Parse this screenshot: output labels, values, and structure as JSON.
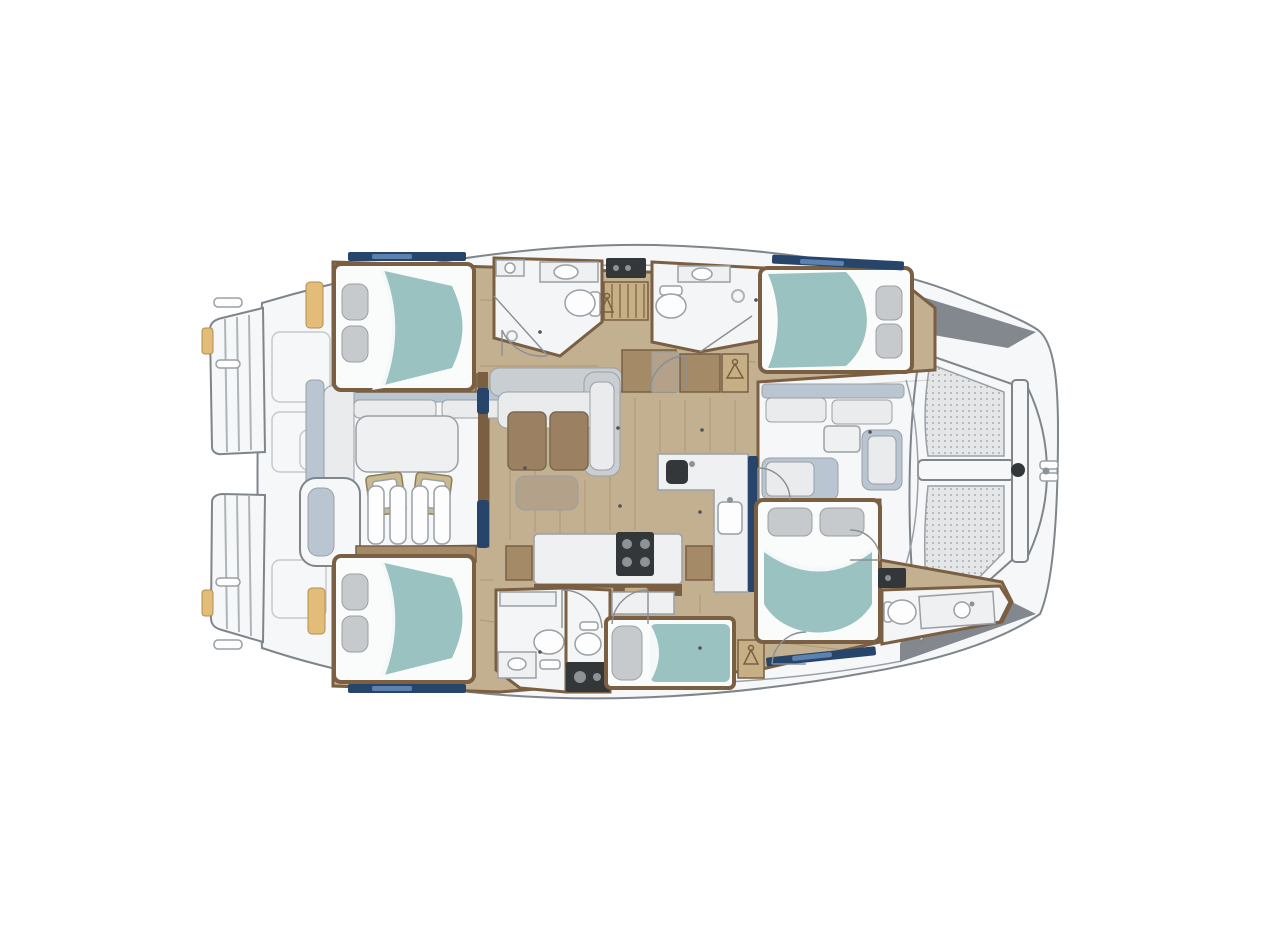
{
  "canvas": {
    "width": 1261,
    "height": 945,
    "background": "#ffffff"
  },
  "colors": {
    "background": "#ffffff",
    "outline": "#7e858b",
    "outline_soft": "#9aa0a5",
    "deck": "#f6f7f8",
    "dark_wedge": "#82888d",
    "wood_floor": "#c3b090",
    "wood_trim": "#7a5f43",
    "wood_cabinet": "#a58a68",
    "plank_line": "rgba(90,70,40,0.22)",
    "room_white": "#f4f5f6",
    "fixture_white": "#fdfdfd",
    "counter_white": "#eef0f1",
    "appliance_dark": "#33373a",
    "appliance_knob": "#8d9296",
    "bed_teal": "#9ac2c1",
    "sheet_white": "#fafbfb",
    "pillow_gray": "#c7cacc",
    "pillow_edge": "#9ba0a3",
    "sofa_gray": "#c9ced3",
    "cushion_white": "#e9ebed",
    "seat_bluegray": "#b9c6d2",
    "table_brown": "#9b8161",
    "table_edge": "#7a6a50",
    "ottoman_tan": "#b3a189",
    "locker_tan": "#c6ae85",
    "navy": "#27456b",
    "navy_light": "#5e82b0",
    "gold": "#e2bc78",
    "gold_edge": "#b18f4e",
    "chair_khaki": "#c9b98f",
    "chair_edge": "#8c7d57",
    "arc_gray": "#8a8f94",
    "step_line": "#aeb4b8",
    "panel_line": "#c6cacd",
    "floor_dot": "#4e5358",
    "mesh_bg": "#e4e6e8",
    "mesh_dot": "#a9adb1",
    "teak_dark": "#6f5540"
  },
  "boat": {
    "kind": "catamaran-yacht-floor-plan",
    "orientation": "bow-right",
    "rooms": [
      {
        "id": "aft-cockpit",
        "type": "cockpit-with-table-and-helm",
        "position": "stern-left"
      },
      {
        "id": "port-aft-cabin",
        "type": "double-bed-cabin",
        "position": "top-left"
      },
      {
        "id": "port-aft-head",
        "type": "bathroom-toilet-sink-shower",
        "position": "top-center-left"
      },
      {
        "id": "companionway",
        "type": "stairs",
        "position": "top-center"
      },
      {
        "id": "port-fwd-head",
        "type": "bathroom-toilet-sink-shower",
        "position": "top-center-right"
      },
      {
        "id": "port-fwd-cabin",
        "type": "double-bed-cabin",
        "position": "top-right"
      },
      {
        "id": "saloon-galley",
        "type": "sofa-table-galley-island",
        "position": "center"
      },
      {
        "id": "fwd-cockpit",
        "type": "forward-seating",
        "position": "bow-center"
      },
      {
        "id": "trampoline",
        "type": "net-with-crossbeam",
        "position": "bow-right"
      },
      {
        "id": "stbd-aft-cabin",
        "type": "double-bed-cabin",
        "position": "bottom-left"
      },
      {
        "id": "stbd-aft-head",
        "type": "bathroom-two-toilets-washer",
        "position": "bottom-center"
      },
      {
        "id": "stbd-single-berth",
        "type": "single-berth",
        "position": "bottom-center-right"
      },
      {
        "id": "stbd-fwd-cabin",
        "type": "double-bed-cabin",
        "position": "bottom-right"
      },
      {
        "id": "stbd-fwd-head",
        "type": "bathroom-toilet-sink",
        "position": "bow-bottom"
      }
    ]
  }
}
